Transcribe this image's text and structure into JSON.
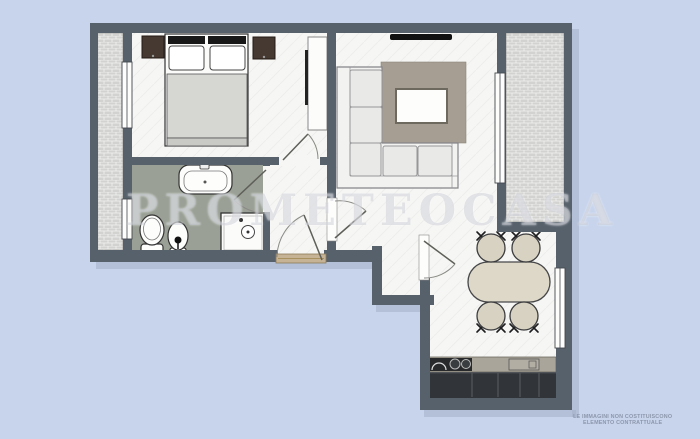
{
  "watermark": {
    "text": "PROMETEOCASA"
  },
  "disclaimer": {
    "line1": "LE IMMAGINI NON COSTITUISCONO",
    "line2": "ELEMENTO CONTRATTUALE"
  },
  "colors": {
    "bg": "#c7d4ec",
    "wall": "#57616c",
    "shadow": "#a3aec8",
    "floor": "#f6f6f4",
    "bath_floor": "#9aa095",
    "balcony_brick": "#d2d2d0",
    "rug": "#a69e92",
    "sofa": "#f2f2f0",
    "blanket": "#d6d6d2",
    "table": "#ddd8c7",
    "chair": "#d7d2c2",
    "counter": "#a9a59b",
    "cabinet": "#313438",
    "threshold": "#c6b294"
  }
}
